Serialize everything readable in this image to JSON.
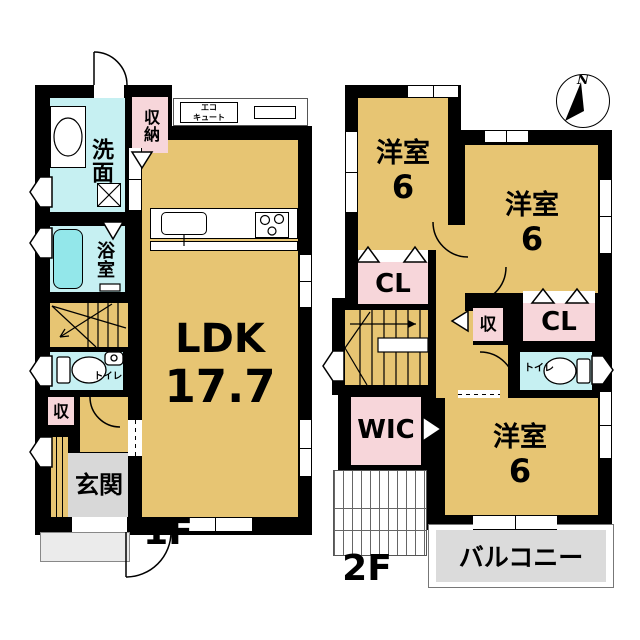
{
  "title": "2-story house floor plan",
  "colors": {
    "room_tan": "#E7C573",
    "water_cyan": "#C6F0F2",
    "bathtub_cyan": "#93E7EA",
    "closet_pink": "#F7D6DA",
    "entrance_gray": "#D8D8D8",
    "balcony_gray": "#DBDBDB",
    "wall_black": "#000000"
  },
  "floor1": {
    "floor_label": "1F",
    "washroom": "洗面",
    "storage_closet": "収納",
    "eco_cute_line1": "エコ",
    "eco_cute_line2": "キュート",
    "bath": "浴室",
    "ldk_name": "LDK",
    "ldk_area": "17.7",
    "toilet": "トイレ",
    "storage_small": "収",
    "entrance": "玄関"
  },
  "floor2": {
    "floor_label": "2F",
    "bedroom_nw_name": "洋室",
    "bedroom_nw_area": "6",
    "bedroom_ne_name": "洋室",
    "bedroom_ne_area": "6",
    "bedroom_s_name": "洋室",
    "bedroom_s_area": "6",
    "closet_left": "CL",
    "closet_right": "CL",
    "storage_small": "収",
    "toilet": "トイレ",
    "walk_in_closet": "WIC",
    "balcony": "バルコニー"
  },
  "compass": {
    "north_label": "N"
  }
}
